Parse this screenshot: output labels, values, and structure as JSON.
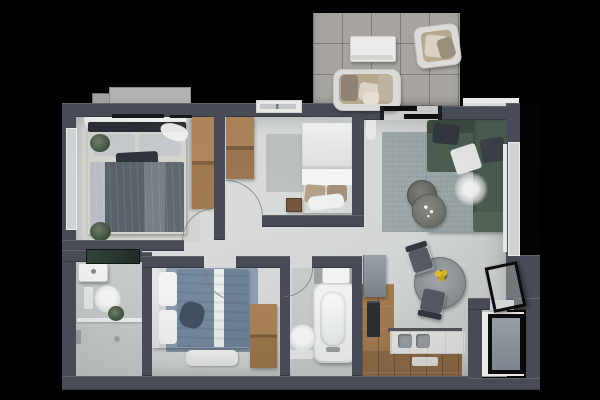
{
  "meta": {
    "title": "Top-down 3D rendered apartment floor plan on black background",
    "canvas": {
      "width": 600,
      "height": 400
    }
  },
  "palette": {
    "bg": "#000000",
    "wall": "#474b55",
    "floor-a": "#dcdedd",
    "floor-b": "#ced1d1",
    "tile": "#a8a5a0",
    "wood-a": "#a37b51",
    "wood-b": "#8f6a45",
    "sofa": "#4b5e50",
    "sofa-dark": "#3f5144",
    "rug-living": "#9aa5a7",
    "rug-blue": "#8b9cae",
    "rug-gray": "#b7bcbc",
    "rug-beige": "#d3d3cd",
    "bath-floor": "#c6cac8",
    "bed-dark": "#596069",
    "bed-blue": "#75889d",
    "linen": "#eff1f0",
    "pillow": "#c4c7cc",
    "pillow-dark": "#2e3339",
    "tan": "#b6a78f",
    "taupe": "#8e8374",
    "cream": "#d9d2c5",
    "table": "#9b9ea2",
    "chair": "#4e525a",
    "flower": "#d9b52a",
    "plant": "#53624d",
    "glass": "#2b3a31",
    "ink": "#0c0c0d",
    "white": "#ecebe9",
    "mat": "#8d949c",
    "winglass": "#ced2d4",
    "counter": "#e8e9e7",
    "appliance": "#2b2e31",
    "cabinet": "#8b9198",
    "arc": "rgba(116,122,128,.75)"
  },
  "scene": {
    "balcony": {
      "floor": "gray-tiles",
      "items": [
        "outdoor-loveseat",
        "outdoor-armchair",
        "outdoor-coffee-table"
      ]
    },
    "living_room": {
      "items": [
        "corner-sofa-green",
        "area-rug",
        "nesting-coffee-tables",
        "fur-throw",
        "curtain",
        "sliding-glass-door",
        "window"
      ]
    },
    "bedroom_main": {
      "items": [
        "double-bed-dark",
        "beige-rug",
        "wardrobe-wood",
        "curtains",
        "curtain-rails",
        "plant-pouf",
        "plant-pouf",
        "window"
      ]
    },
    "bedroom_second": {
      "items": [
        "single-bed-white",
        "wardrobe-wood",
        "gray-rug",
        "nightstand",
        "window"
      ]
    },
    "bedroom_third": {
      "items": [
        "double-bed-blue",
        "blue-rug",
        "wardrobe-wood",
        "bench-white"
      ]
    },
    "bathroom_main": {
      "items": [
        "washbasin",
        "toilet",
        "potted-plant",
        "walk-in-shower",
        "glass-screen-dark"
      ]
    },
    "bathroom_second": {
      "items": [
        "vanity-washbasin",
        "bathtub",
        "toilet"
      ]
    },
    "kitchen": {
      "items": [
        "tall-cabinet",
        "oven-dark",
        "countertop",
        "double-sink",
        "kitchen-mat",
        "wood-flooring"
      ]
    },
    "dining": {
      "items": [
        "round-table",
        "yellow-flower-centerpiece",
        "dining-chair",
        "dining-chair"
      ]
    },
    "entry": {
      "items": [
        "entrance-door-black-frame",
        "vestibule",
        "doormat"
      ]
    },
    "exterior": {
      "items": [
        "ac-unit",
        "window-ledge",
        "window-sill",
        "window-sill"
      ]
    }
  }
}
